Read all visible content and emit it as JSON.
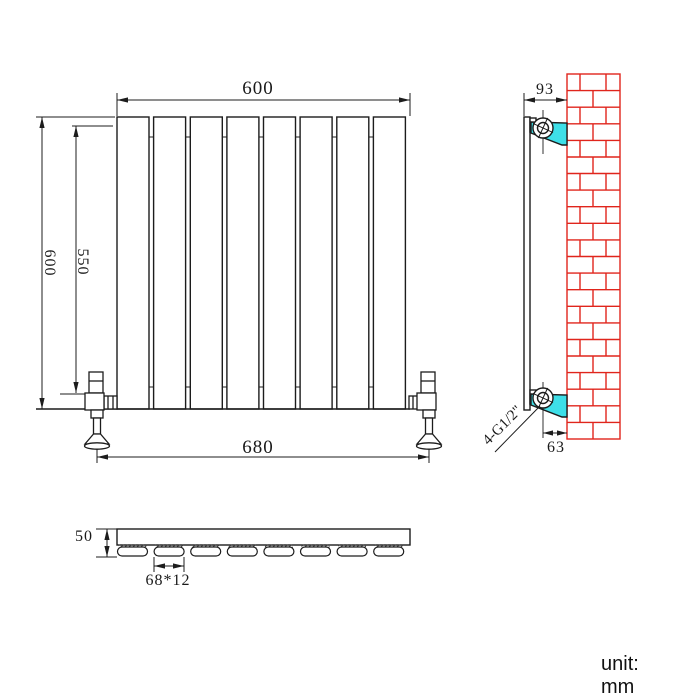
{
  "meta": {
    "unit_label": "unit: mm"
  },
  "front_view": {
    "title": "radiator front elevation",
    "panel_count": 8,
    "dimensions": {
      "width_top": "600",
      "height_left": "600",
      "height_inner": "550",
      "valve_span": "680"
    }
  },
  "side_view": {
    "title": "radiator side section on brick wall",
    "dimensions": {
      "depth_top": "93",
      "depth_bottom": "63"
    },
    "connection_label": "4-G1/2\"",
    "bracket_color": "#3edfe8",
    "brick_color": "#e0251c"
  },
  "plan_view": {
    "title": "radiator top section",
    "panel_count": 8,
    "dimensions": {
      "height": "50",
      "panel_size": "68*12"
    }
  },
  "colors": {
    "line": "#1c1c1c"
  }
}
